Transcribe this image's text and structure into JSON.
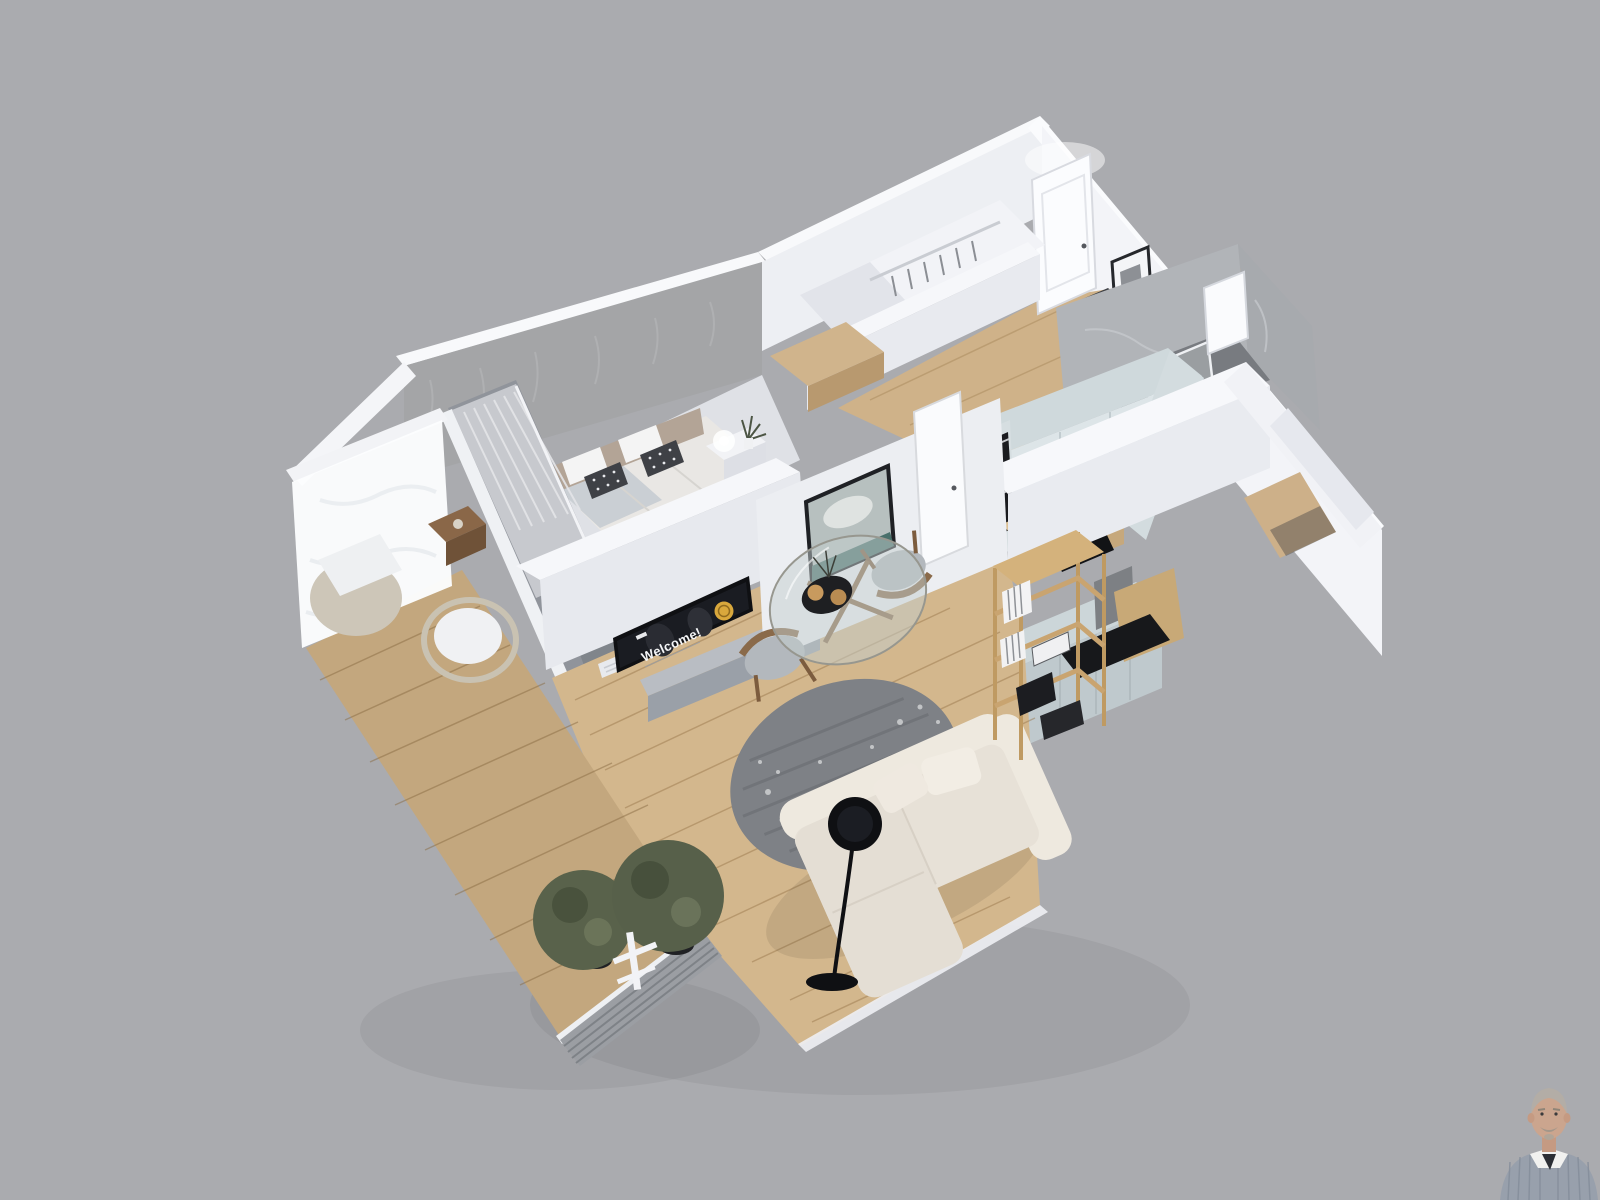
{
  "scene": {
    "type": "3d-floorplan-render",
    "background_color": "#aaabaf",
    "view": "dollhouse top-down perspective, apartment rotated diagonally"
  },
  "apartment": {
    "rooms": [
      {
        "name": "Balcony",
        "floor": "wood decking",
        "items": [
          "frosted glass balustrade",
          "slatted railing",
          "white cushioned armchair",
          "rattan armchair",
          "wooden side table",
          "two potted olive trees"
        ]
      },
      {
        "name": "Bedroom",
        "wall": "gray textured wallpaper",
        "items": [
          "double bed",
          "beige upholstered headboard",
          "white pillows",
          "black-and-white patterned pillows",
          "white nightstand",
          "lit table lamp",
          "plant in vase",
          "sheer curtains on balcony windows"
        ]
      },
      {
        "name": "Living room",
        "floor": "light oak planks",
        "items": [
          "wall-mounted TV",
          "gray media console",
          "round gray floral rug",
          "beige chaise sofa",
          "black arc floor lamp",
          "framed seascape painting",
          "radiator"
        ]
      },
      {
        "name": "Dining area",
        "items": [
          "round glass table with wooden legs",
          "two wooden chairs with gray seats",
          "black serving tray with cups",
          "flower sprigs"
        ]
      },
      {
        "name": "Kitchen",
        "items": [
          "pale blue-gray cabinets",
          "built-in double oven",
          "black sink with faucet",
          "coffee machine",
          "wooden worktop",
          "peninsula with black counter",
          "wooden open shelving with books and boxes"
        ]
      },
      {
        "name": "Hallway",
        "floor": "light oak",
        "items": [
          "white entrance door",
          "two framed pictures",
          "dark shoe cabinet",
          "interior door"
        ]
      },
      {
        "name": "Walk-in closet",
        "items": [
          "white wardrobe walls",
          "wooden counter",
          "hanging rail with clothes"
        ]
      },
      {
        "name": "Bathroom",
        "wall": "gray marble",
        "items": [
          "glass shower enclosure",
          "LED shower column",
          "white door",
          "dark tile floor"
        ]
      }
    ]
  },
  "tv": {
    "screen_text": "Welcome!",
    "screen_bg": "#15171c",
    "emblem_color": "#d9a83c"
  },
  "agent_photo": {
    "position": "bottom-right",
    "description": "man with short gray hair and mustache wearing a striped shirt"
  },
  "palette": {
    "walls": "#f2f3f7",
    "wood_floor": "#d3b78d",
    "kitchen_cabinets": "#ccd7da",
    "rug": "#7e8186",
    "sofa": "#e6e0d6",
    "marble": "#b1b4b8"
  }
}
